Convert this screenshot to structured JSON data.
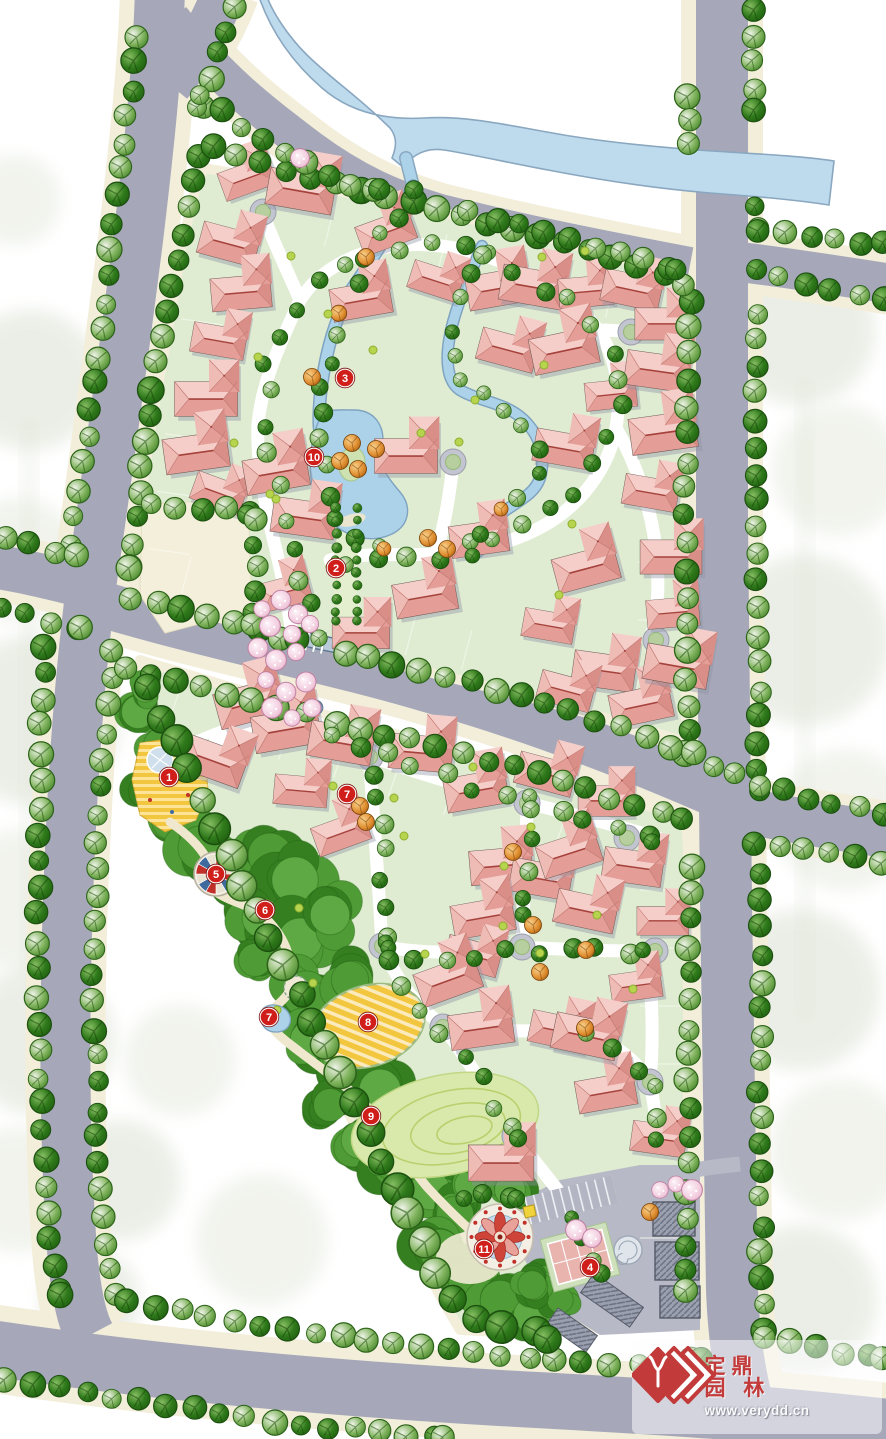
{
  "watermark": {
    "brand_top": "定鼎",
    "brand_bottom": "园 林",
    "url": "www.verydd.cn",
    "accent": "#c23a3a"
  },
  "markers": {
    "fill": "#d01f1a",
    "text_color": "#ffffff",
    "items": [
      {
        "label": "1",
        "x": 169,
        "y": 777
      },
      {
        "label": "2",
        "x": 336,
        "y": 568
      },
      {
        "label": "3",
        "x": 345,
        "y": 378
      },
      {
        "label": "4",
        "x": 590,
        "y": 1267
      },
      {
        "label": "5",
        "x": 216,
        "y": 874
      },
      {
        "label": "6",
        "x": 265,
        "y": 910
      },
      {
        "label": "7",
        "x": 347,
        "y": 794
      },
      {
        "label": "7",
        "x": 269,
        "y": 1017
      },
      {
        "label": "8",
        "x": 368,
        "y": 1022
      },
      {
        "label": "9",
        "x": 371,
        "y": 1116
      },
      {
        "label": "10",
        "x": 314,
        "y": 457
      },
      {
        "label": "11",
        "x": 484,
        "y": 1249
      }
    ]
  },
  "palette": {
    "road": "#a6a8b9",
    "verge": "#f2eeda",
    "river": "#bedbee",
    "riveredge": "#8aa7c0",
    "parcel": "#dfecd2",
    "pond": "#abd2e8",
    "pondedge": "#7fa3c0",
    "island": "#cde2b0",
    "belt1": "#4f9b35",
    "belt2": "#367f20",
    "belt3": "#1d5c0e",
    "treedark": "#2f7a1b",
    "treelight": "#7fb35c",
    "orange": "#df8c2e",
    "cherry": "#f2cbdd",
    "house": "#e8a59f",
    "houseridge": "#a6423c",
    "plaza": "#f3c63f",
    "lawn": "#d9e9ab",
    "court": "#e9b3ae",
    "club": "#9aa0b0",
    "gate": "#b9cad8",
    "beige": "#f4efdb",
    "marker": "#d01f1a",
    "wmaccent": "#c23a3a",
    "ghost1": "#e8ece1",
    "ghost2": "#dfe4d7"
  }
}
